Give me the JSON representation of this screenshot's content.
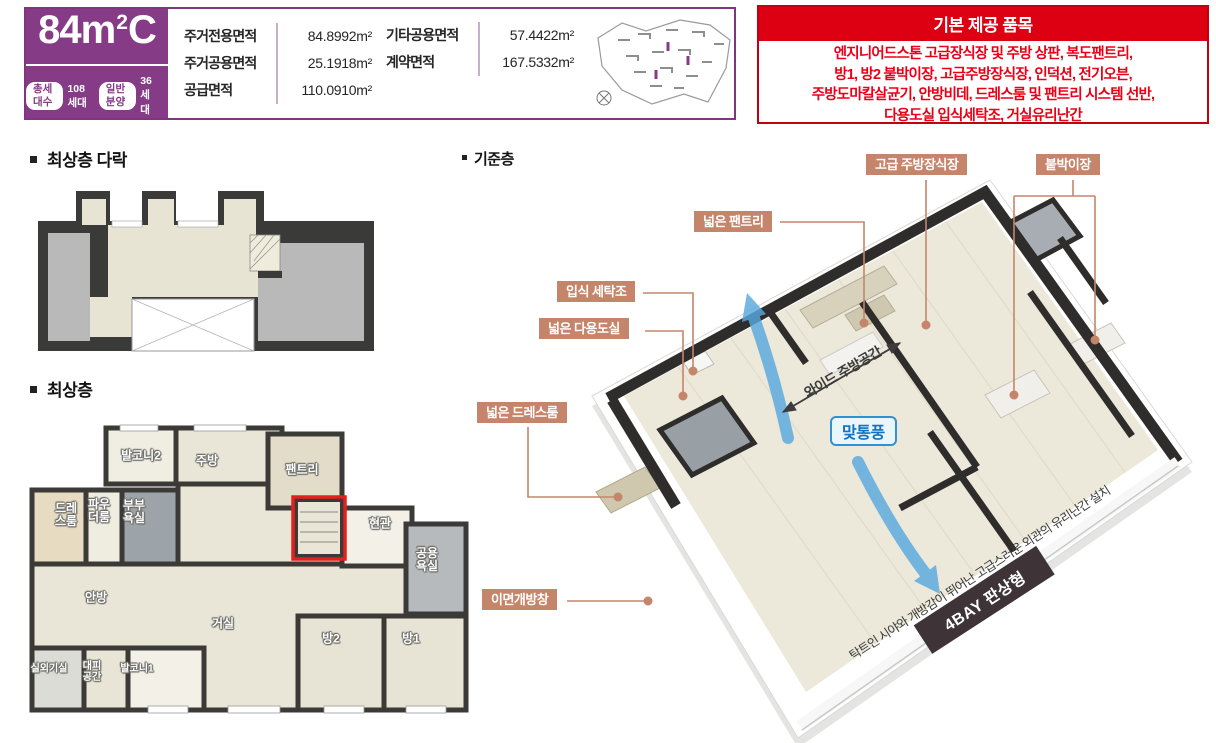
{
  "unit": {
    "size_num": "84",
    "size_mid": "m",
    "size_sup": "2",
    "size_suffix": "C",
    "stats": [
      {
        "label": "총세대수",
        "value": "108세대"
      },
      {
        "label": "일반분양",
        "value": "36세대"
      }
    ]
  },
  "area_table": {
    "col1": [
      {
        "label": "주거전용면적",
        "value": "84.8992m²"
      },
      {
        "label": "주거공용면적",
        "value": "25.1918m²"
      },
      {
        "label": "공급면적",
        "value": "110.0910m²"
      }
    ],
    "col2": [
      {
        "label": "기타공용면적",
        "value": "57.4422m²"
      },
      {
        "label": "계약면적",
        "value": "167.5332m²"
      }
    ]
  },
  "provided_items": {
    "title": "기본 제공 품목",
    "body": "엔지니어드스톤 고급장식장 및 주방 상판, 복도팬트리,\n방1, 방2 붙박이장, 고급주방장식장, 인덕션, 전기오븐,\n주방도마칼살균기, 안방비데, 드레스룸 및 팬트리 시스템 선반,\n다용도실 입식세탁조, 거실유리난간"
  },
  "sections": {
    "attic": {
      "title": "최상층 다락",
      "open_label": "OPEN"
    },
    "top": {
      "title": "최상층",
      "rooms": [
        "발코니2",
        "주방",
        "팬트리",
        "드레\n스룸",
        "파우\n더룸",
        "부부\n욕실",
        "현관",
        "공용\n욕실",
        "안방",
        "거실",
        "방2",
        "방1",
        "실외기실",
        "대피\n공간",
        "발코니1"
      ]
    },
    "standard": {
      "title": "기준층",
      "callouts": [
        "고급 주방장식장",
        "붙박이장",
        "넓은 팬트리",
        "입식 세탁조",
        "넓은 다용도실",
        "넓은 드레스룸",
        "이면개방창"
      ],
      "vent_badge": "맞통풍",
      "kitchen_span": "와이드 주방공간",
      "bay_banner": "4BAY 판상형",
      "caption": "탁트인 시야와 개방감이 뛰어난 고급스러운 외관의 유리난간 설치"
    }
  },
  "colors": {
    "purple": "#853b86",
    "red": "#dc0012",
    "callout_tan": "#c5856b",
    "banner_dark": "#3e3437",
    "vent_blue": "#1173bd",
    "arrow_blue": "#58a9de",
    "wall_dark": "#2e2d2b",
    "floor_beige": "#ece8da"
  }
}
